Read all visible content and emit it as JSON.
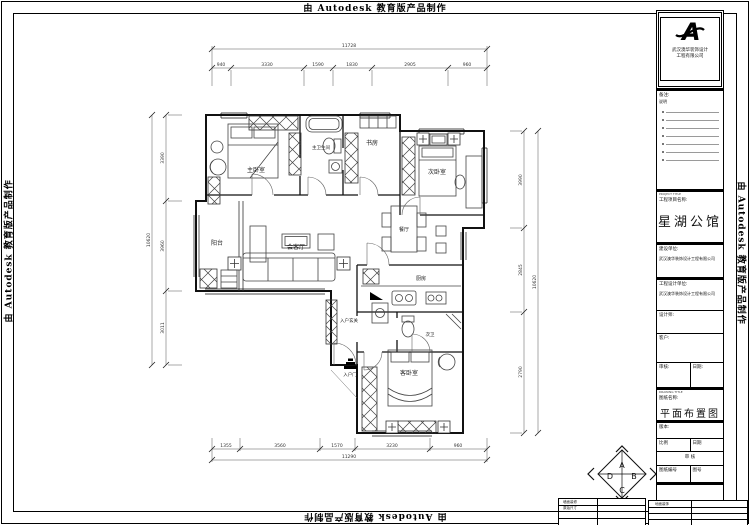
{
  "watermark": {
    "text": "由 Autodesk 教育版产品制作"
  },
  "title_block": {
    "logo": {
      "letter": "A",
      "company_line1": "武汉澳华装饰设计",
      "company_line2": "工程有限公司"
    },
    "notes": {
      "label": "备注:",
      "sublabel": "说明"
    },
    "project": {
      "en": "PROJECT TITLE",
      "label": "工程项目名称:",
      "name": "星湖公馆"
    },
    "build_unit": {
      "label": "建设单位:",
      "value": "武汉澳华装饰设计工程有限公司"
    },
    "design_unit": {
      "label": "工程设计单位:",
      "value": "武汉澳华装饰设计工程有限公司"
    },
    "designer_label": "设计师:",
    "client_label": "客户:",
    "audit_label": "审核:",
    "date_label": "日期:",
    "drawing": {
      "en": "DRAWING TITLE",
      "label": "图纸名称:",
      "name": "平面布置图"
    },
    "version_label": "版本:",
    "scale_label": "比例",
    "date2_label": "日期",
    "review_label": "审 核",
    "drawing_no_label": "图纸编号",
    "sheet_no_label": "图号",
    "footer_tables": {
      "left_r1": "墙面装修",
      "left_r2": "原始尺寸",
      "right_r1": "地面装饰"
    }
  },
  "plan": {
    "rooms": {
      "master": "主卧室",
      "master_bath": "主卫生间",
      "study": "书房",
      "bedroom2": "次卧室",
      "balcony": "阳台",
      "living": "会客厅",
      "dining": "餐厅",
      "kitchen": "厨房",
      "foyer": "入户玄关",
      "bath2": "次卫",
      "guest": "客卧室",
      "entry": "入户门"
    }
  },
  "compass": {
    "a": "A",
    "b": "B",
    "c": "C",
    "d": "D"
  },
  "dims": {
    "top": {
      "total": "11728",
      "segments": [
        "940",
        "3330",
        "1590",
        "1830",
        "2905",
        "960"
      ]
    },
    "bottom": {
      "total": "11290",
      "segments": [
        "1355",
        "3560",
        "1570",
        "3230",
        "960"
      ]
    },
    "left": {
      "total": "10620",
      "segments": [
        "3390",
        "3960",
        "3011"
      ]
    },
    "right": {
      "total": "10620",
      "segments": [
        "3990",
        "2845",
        "2790"
      ]
    }
  }
}
